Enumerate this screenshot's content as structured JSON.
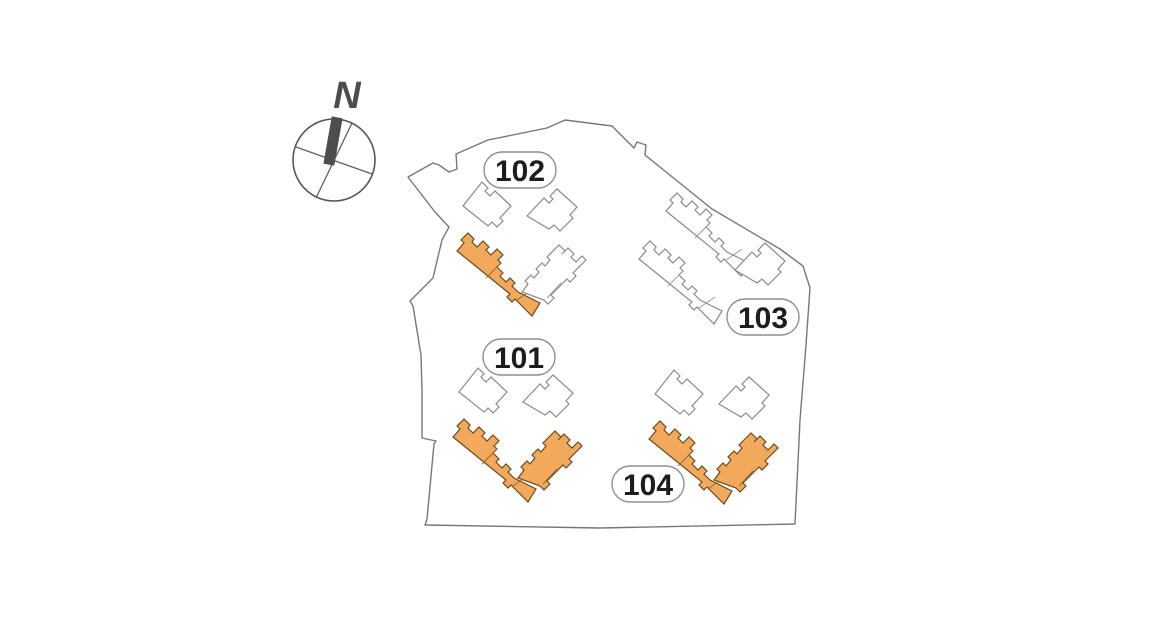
{
  "compass": {
    "north_label": "N"
  },
  "blocks": [
    {
      "id": "101",
      "label": "101",
      "highlighted": true
    },
    {
      "id": "102",
      "label": "102",
      "highlighted": true
    },
    {
      "id": "103",
      "label": "103",
      "highlighted": false
    },
    {
      "id": "104",
      "label": "104",
      "highlighted": true
    }
  ],
  "colors": {
    "highlight_fill": "#F2A95C",
    "highlight_stroke": "#6A4B20",
    "building_stroke": "#8A8A8A",
    "boundary_stroke": "#7B766F",
    "label_text": "#1D1D1F",
    "compass": "#4D4D4D"
  }
}
